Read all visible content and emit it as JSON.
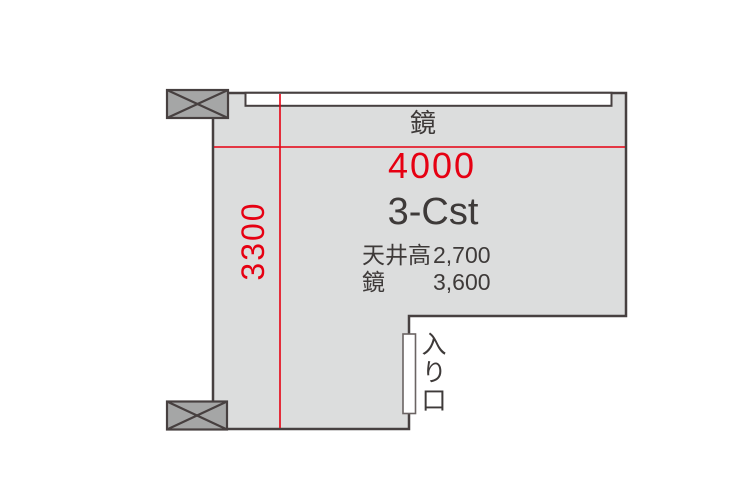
{
  "floorplan": {
    "room": {
      "name": "3-Cst",
      "width_dimension": "4000",
      "depth_dimension": "3300"
    },
    "mirror_wall_label": "鏡",
    "specs": [
      {
        "label": "天井高",
        "value": "2,700"
      },
      {
        "label": "鏡",
        "value": "3,600"
      }
    ],
    "entrance_label": "入り口",
    "colors": {
      "floor_fill": "#dcdddd",
      "wall_stroke": "#474040",
      "pillar_fill": "#a5a6a6",
      "dimension_red": "#e60012",
      "text_dark": "#3e3a39"
    }
  }
}
